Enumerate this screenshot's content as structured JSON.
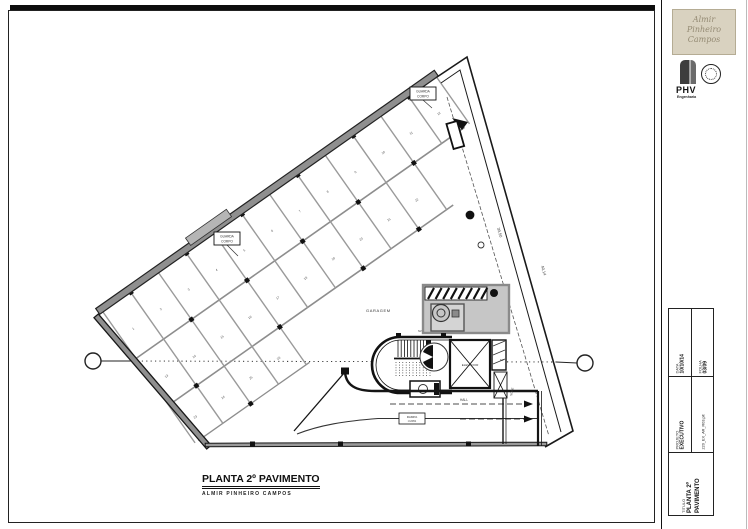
{
  "colors": {
    "line": "#1a1a1a",
    "wall_gray": "#8f8f8f",
    "machine_gray": "#c6c6c6",
    "logo_beige": "#d9d2c0",
    "logo_text": "#958b74"
  },
  "plan": {
    "labels": {
      "garagem": "GARAGEM",
      "elevador": "ELEVADOR",
      "hall": "HALL",
      "rampa_line1": "RAMPA",
      "rampa_line2": "i=20%",
      "sobe": "SOBE",
      "guarda_line1": "GUARDA",
      "guarda_line2": "CORPO",
      "nivel_1": "NV.",
      "nivel_2": "NV.",
      "dim_inner": "39,50",
      "dim_outer": "40,14"
    },
    "stalls": {
      "row1": [
        "1",
        "2",
        "3",
        "4",
        "5",
        "6",
        "7",
        "8",
        "9",
        "10",
        "11",
        "12"
      ],
      "row2": [
        "13",
        "14",
        "15",
        "16",
        "17",
        "18",
        "19",
        "20",
        "21",
        "22"
      ],
      "row3": [
        "23",
        "24",
        "25",
        "26"
      ]
    }
  },
  "footer": {
    "title": "PLANTA 2º PAVIMENTO",
    "subtitle": "ALMIR PINHEIRO CAMPOS"
  },
  "title_block": {
    "logo_lines": [
      "Almir",
      "Pinheiro",
      "Campos"
    ],
    "phv_name": "PHV",
    "phv_subtitle": "Engenharia",
    "fields": {
      "data_label": "DATA",
      "data_value": "10/10/14",
      "folha_label": "FOLHA",
      "folha_value": "03/09",
      "projeto_label": "PROJETO",
      "projeto_value": "EXECUTIVO",
      "file_value": "220_EX_AR_R03.plt",
      "titulo_label": "TITULO",
      "titulo_value": "PLANTA 2º PAVIMENTO"
    }
  }
}
